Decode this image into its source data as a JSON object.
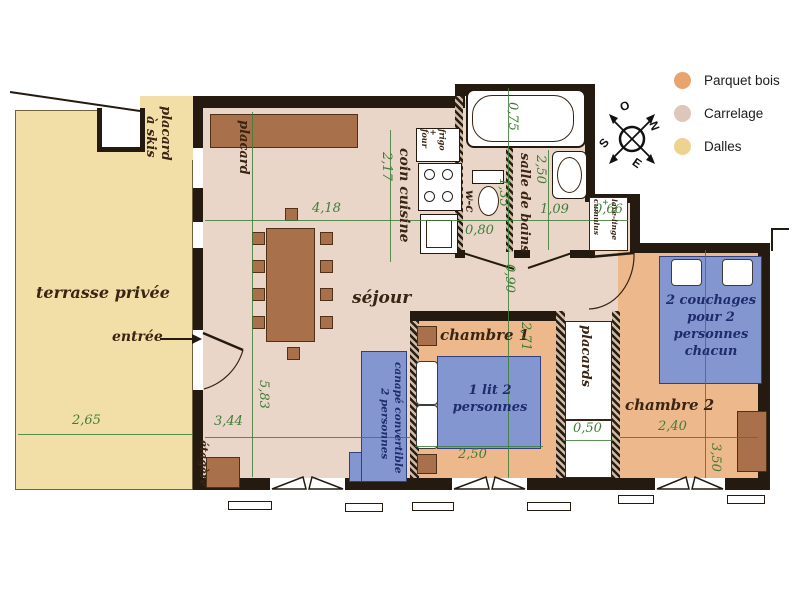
{
  "legend": {
    "items": [
      {
        "label": "Parquet bois",
        "color": "#e7a46c"
      },
      {
        "label": "Carrelage",
        "color": "#ddc6ba"
      },
      {
        "label": "Dalles",
        "color": "#eed28f"
      }
    ]
  },
  "compass": {
    "o": "O",
    "n": "N",
    "s": "S",
    "e": "E"
  },
  "colors": {
    "dalles": "#f1dfa7",
    "carrelage": "#e9d6c8",
    "parquet": "#edb98c",
    "furniture": "#a9714b",
    "bed": "#8396cf",
    "wall": "#241a10",
    "dimension": "#3f7d38"
  },
  "rooms": {
    "terrace": "terrasse privée",
    "entry": "entrée",
    "ski_closet_l1": "placard",
    "ski_closet_l2": "à skis",
    "closet": "placard",
    "living": "séjour",
    "kitchen": "coin cuisine",
    "fridge_l1": "frigo",
    "fridge_l2": "+",
    "fridge_l3": "four",
    "bathroom": "salle de bains",
    "wc": "w-c",
    "laundry_l1": "lave-linge",
    "laundry_l2": "+",
    "laundry_l3": "cumulus",
    "bedroom1": "chambre 1",
    "bedroom2": "chambre 2",
    "closets": "placards",
    "shelf": "étagère"
  },
  "furniture": {
    "bed1": "1 lit 2 personnes",
    "bed2": "2 couchages pour 2 personnes chacun",
    "sofa_l1": "canapé convertible",
    "sofa_l2": "2 personnes"
  },
  "dimensions": {
    "terrace_width": "2,65",
    "living_width": "3,44",
    "living_length": "5,83",
    "living_top": "4,18",
    "kitchen": "2,17",
    "bath_tub": "0,75",
    "bath_length": "2,50",
    "bath_width": "1,35",
    "wc_width": "0,80",
    "bath_right": "1,09",
    "laundry": "0,66",
    "hall": "0,90",
    "bedroom1_length": "2,71",
    "bed1_width": "2,50",
    "closets_depth": "0,50",
    "bedroom2_width": "2,40",
    "bedroom2_length": "3,50"
  }
}
